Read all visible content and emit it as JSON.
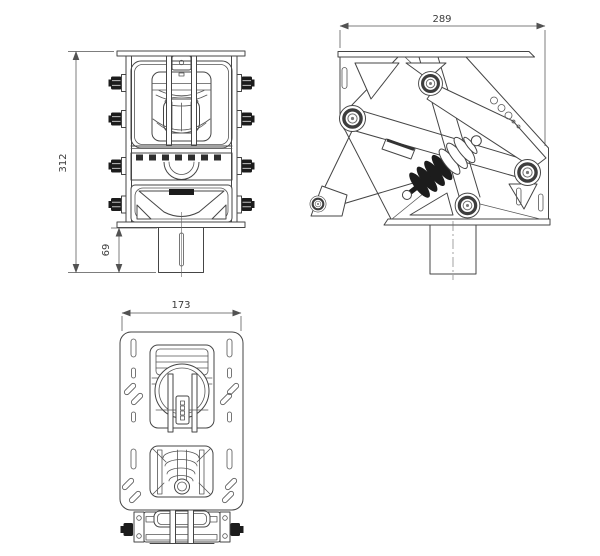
{
  "drawing": {
    "dimensions": {
      "overall_height": "312",
      "shaft_height": "69",
      "side_width": "289",
      "top_width": "173"
    },
    "colors": {
      "line": "#454545",
      "dimension_line": "#525252",
      "bolt_fill": "#1c1c1c",
      "background": "#ffffff"
    }
  }
}
